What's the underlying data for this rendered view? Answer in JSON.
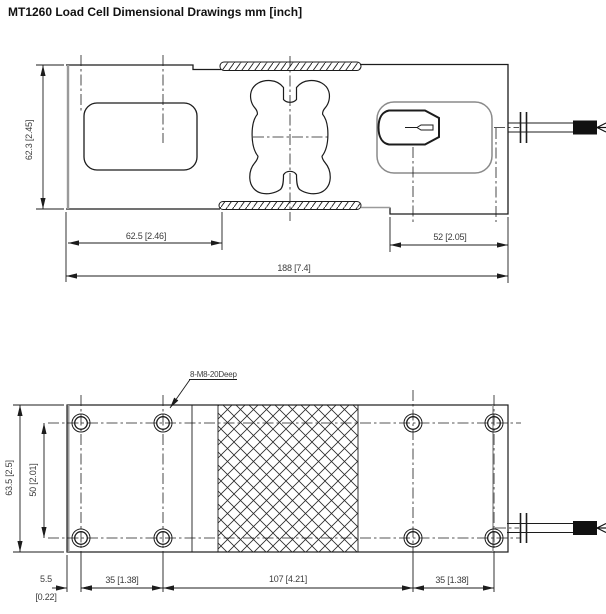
{
  "title": "MT1260 Load Cell Dimensional Drawings mm [inch]",
  "side_view": {
    "dim_height": "62.3 [2.45]",
    "dim_left_section": "62.5 [2.46]",
    "dim_right_section": "52 [2.05]",
    "dim_overall_length": "188 [7.4]"
  },
  "plan_view": {
    "thread_note": "8-M8-20Deep",
    "dim_width": "63.5 [2.5]",
    "dim_hole_row_spacing": "50 [2.01]",
    "dim_edge_to_hole_mm": "5.5",
    "dim_edge_to_hole_inch": "[0.22]",
    "dim_hole_span_left": "35 [1.38]",
    "dim_hole_span_center": "107 [4.21]",
    "dim_hole_span_right": "35 [1.38]"
  },
  "colors": {
    "line": "#1c1c1c",
    "dim_text": "#3c3c3c",
    "light_line": "#9a9a9a"
  }
}
